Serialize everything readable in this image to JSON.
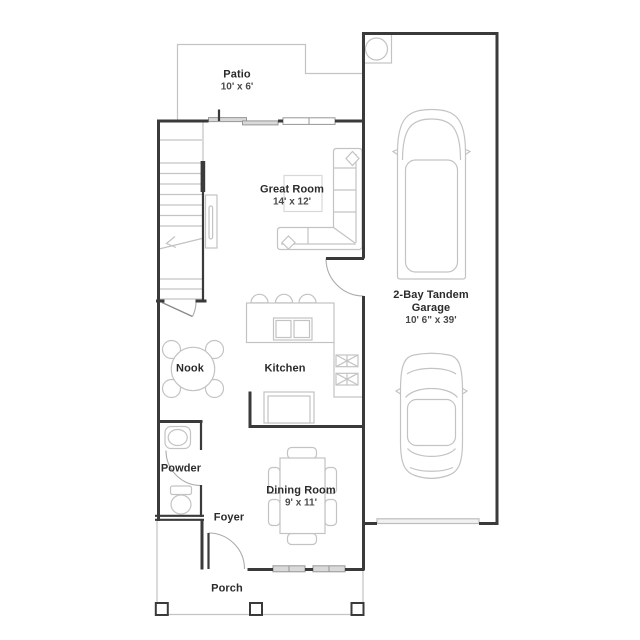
{
  "plan_type": "floor-plan",
  "rooms": {
    "patio": {
      "name": "Patio",
      "dims": "10' x 6'"
    },
    "great_room": {
      "name": "Great Room",
      "dims": "14' x 12'"
    },
    "garage": {
      "name_line1": "2-Bay Tandem",
      "name_line2": "Garage",
      "dims": "10' 6\" x 39'"
    },
    "kitchen": {
      "name": "Kitchen"
    },
    "nook": {
      "name": "Nook"
    },
    "powder": {
      "name": "Powder"
    },
    "dining_room": {
      "name": "Dining Room",
      "dims": "9' x 11'"
    },
    "foyer": {
      "name": "Foyer"
    },
    "porch": {
      "name": "Porch"
    }
  },
  "colors": {
    "wall": "#3a3a3a",
    "line_light": "#c3c3c3",
    "window_fill": "#d9d9d9",
    "text_primary": "#2b2b2b",
    "text_secondary": "#4a4a4a",
    "background": "#ffffff"
  }
}
